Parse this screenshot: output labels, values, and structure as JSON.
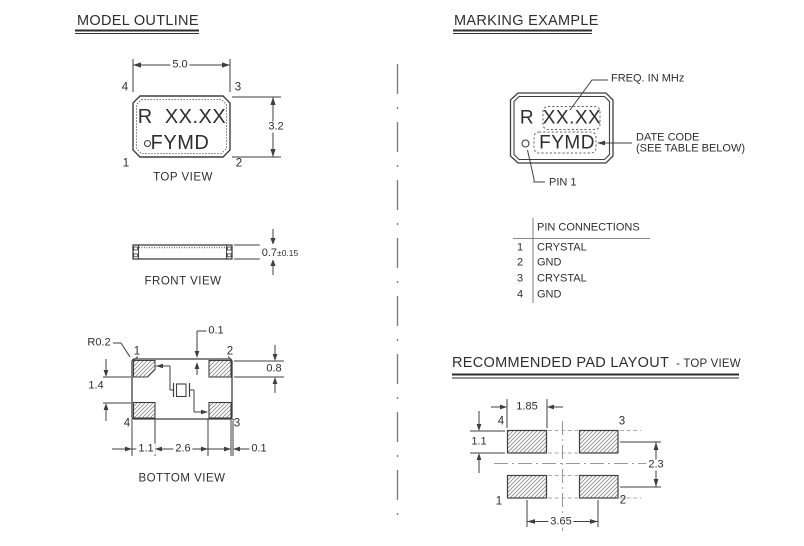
{
  "colors": {
    "line": "#3f3f3f",
    "text": "#2e2e2e",
    "gray_dash": "#9a9a9a",
    "hatch": "#8f8f8f"
  },
  "model_outline": {
    "title": "MODEL OUTLINE",
    "top_view": {
      "label": "TOP VIEW",
      "marking_line1": "R  XX.XX",
      "marking_line2": "FYMD",
      "dim_width": "5.0",
      "dim_height": "3.2",
      "pin_tl": "4",
      "pin_tr": "3",
      "pin_bl": "1",
      "pin_br": "2"
    },
    "front_view": {
      "label": "FRONT VIEW",
      "dim_thickness": "0.7",
      "dim_tolerance": "±0.15"
    },
    "bottom_view": {
      "label": "BOTTOM VIEW",
      "dim_corner_radius": "R0.2",
      "dim_pad_top_offset": "0.1",
      "dim_pad_vertical_gap": "1.4",
      "dim_pad_height": "0.8",
      "dim_pad_width": "1.1",
      "dim_pad_spacing": "2.6",
      "dim_pad_side_offset": "0.1",
      "pin_tl": "1",
      "pin_tr": "2",
      "pin_bl": "4",
      "pin_br": "3"
    }
  },
  "marking_example": {
    "title": "MARKING EXAMPLE",
    "marking_prefix": "R",
    "marking_freq": "XX.XX",
    "marking_datecode": "FYMD",
    "callout_freq": "FREQ. IN MHz",
    "callout_datecode_line1": "DATE CODE",
    "callout_datecode_line2": "(SEE TABLE BELOW)",
    "callout_pin1": "PIN 1"
  },
  "pin_connections": {
    "header": "PIN CONNECTIONS",
    "rows": [
      {
        "pin": "1",
        "conn": "CRYSTAL"
      },
      {
        "pin": "2",
        "conn": "GND"
      },
      {
        "pin": "3",
        "conn": "CRYSTAL"
      },
      {
        "pin": "4",
        "conn": "GND"
      }
    ]
  },
  "pad_layout": {
    "title": "RECOMMENDED PAD LAYOUT",
    "subtitle": "- TOP VIEW",
    "dim_pad_width": "1.85",
    "dim_pad_height": "1.1",
    "dim_vertical_pitch": "2.3",
    "dim_horizontal_pitch": "3.65",
    "pin_tl": "4",
    "pin_tr": "3",
    "pin_bl": "1",
    "pin_br": "2"
  }
}
